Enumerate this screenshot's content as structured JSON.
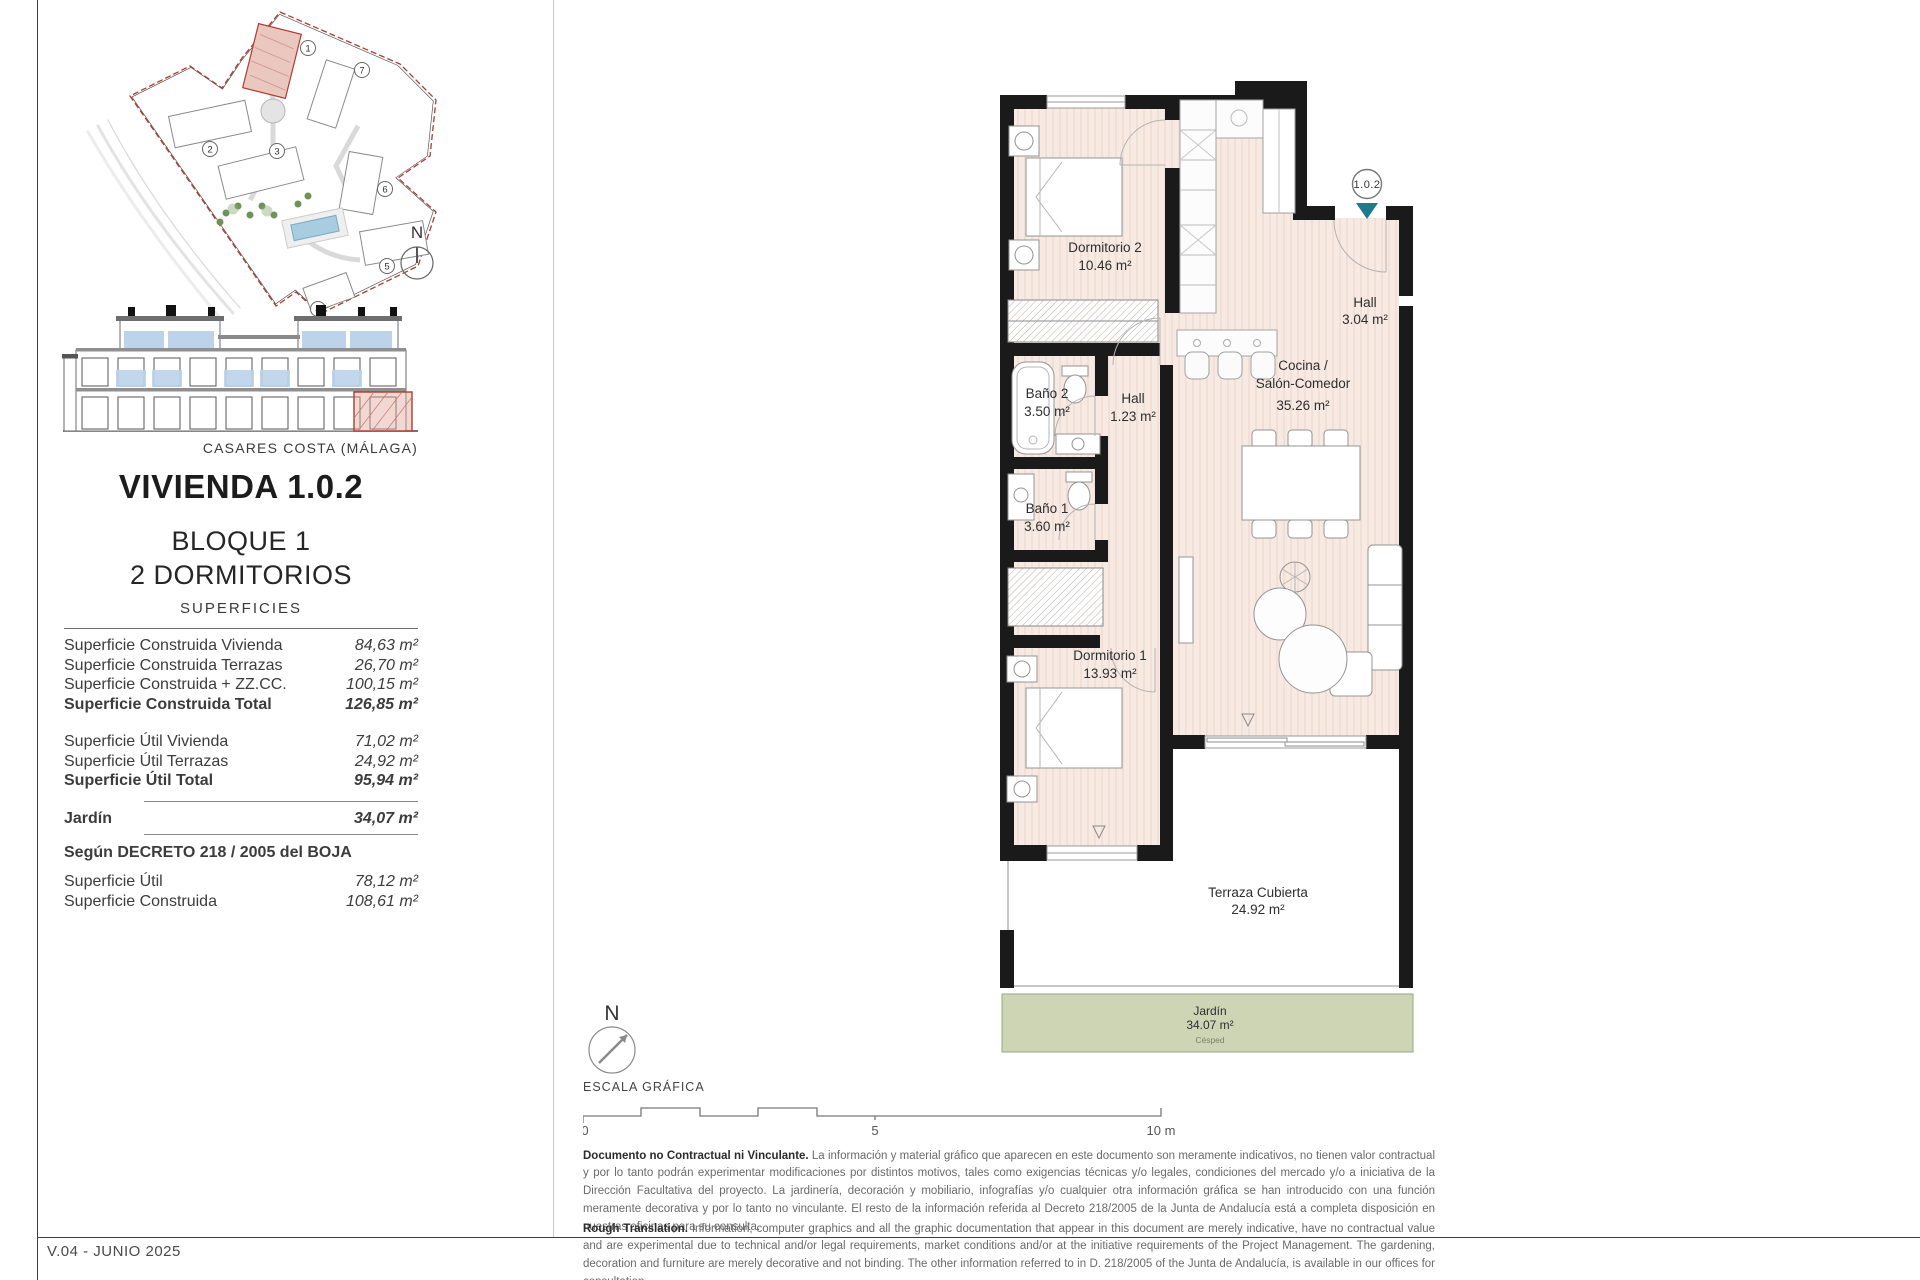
{
  "page": {
    "footer": "V.04 - JUNIO 2025",
    "caption": "CASARES COSTA (MÁLAGA)"
  },
  "header": {
    "title": "VIVIENDA 1.0.2",
    "block": "BLOQUE 1",
    "bedrooms": "2 DORMITORIOS"
  },
  "superficies": {
    "heading": "SUPERFICIES",
    "construida": [
      {
        "label": "Superficie Construida Vivienda",
        "value": "84,63 m²"
      },
      {
        "label": "Superficie Construida Terrazas",
        "value": "26,70 m²"
      },
      {
        "label": "Superficie Construida + ZZ.CC.",
        "value": "100,15 m²"
      },
      {
        "label": "Superficie Construida Total",
        "value": "126,85 m²"
      }
    ],
    "util": [
      {
        "label": "Superficie Útil Vivienda",
        "value": "71,02 m²"
      },
      {
        "label": "Superficie Útil Terrazas",
        "value": "24,92 m²"
      },
      {
        "label": "Superficie Útil Total",
        "value": "95,94 m²"
      }
    ],
    "jardin": {
      "label": "Jardín",
      "value": "34,07 m²"
    },
    "decreto_heading": "Según DECRETO 218 / 2005 del BOJA",
    "decreto": [
      {
        "label": "Superficie Útil",
        "value": "78,12 m²"
      },
      {
        "label": "Superficie Construida",
        "value": "108,61 m²"
      }
    ]
  },
  "floor_plan": {
    "unit_marker": "1.0.2",
    "rooms": [
      {
        "name": "Dormitorio 2",
        "area": "10.46 m²"
      },
      {
        "name": "Hall",
        "area": "3.04 m²"
      },
      {
        "name": "Baño 2",
        "area": "3.50 m²"
      },
      {
        "name": "Hall",
        "area": "1.23 m²"
      },
      {
        "name_line1": "Cocina /",
        "name_line2": "Salón-Comedor",
        "area": "35.26 m²"
      },
      {
        "name": "Baño 1",
        "area": "3.60 m²"
      },
      {
        "name": "Dormitorio 1",
        "area": "13.93 m²"
      },
      {
        "name": "Terraza Cubierta",
        "area": "24.92 m²"
      },
      {
        "name": "Jardín",
        "area": "34.07 m²",
        "note": "Césped"
      }
    ]
  },
  "site_plan": {
    "numbers": [
      "1",
      "2",
      "3",
      "4",
      "5",
      "6",
      "7"
    ]
  },
  "compass": {
    "label": "N"
  },
  "scale": {
    "label": "ESCALA GRÁFICA",
    "t0": "0",
    "t5": "5",
    "t10": "10 m"
  },
  "disclaimers": {
    "es_lead": "Documento no Contractual ni Vinculante.",
    "es_body": " La información y material gráfico que aparecen en este documento son meramente indicativos, no tienen valor contractual y por lo tanto podrán experimentar modificaciones por distintos motivos, tales como exigencias técnicas y/o legales, condiciones del mercado y/o a iniciativa de la Dirección Facultativa del proyecto. La jardinería, decoración y mobiliario, infografías y/o cualquier otra información gráfica se han introducido con una función meramente decorativa y por lo tanto no vinculante. El resto de la información referida al Decreto 218/2005 de la Junta de Andalucía está a completa disposición en nuestras oficinas para su consulta.",
    "en_lead": "Rough Translation.",
    "en_body": " Information, computer graphics and all the graphic documentation that appear in this document are merely indicative, have no contractual value and are experimental due to technical and/or legal requirements, market conditions and/or at the initiative requirements of the Project Management. The gardening, decoration and furniture are merely decorative and not binding. The other information referred to in D. 218/2005 of the Junta de Andalucía, is available in our offices for consultation."
  },
  "colors": {
    "floor_pink": "#f7eae3",
    "highlight_pink": "#eac7bf",
    "boundary_red": "#b23a2e",
    "garden_green": "#cdd5b5",
    "marker_teal": "#1e7a90",
    "balcony_blue": "#bcd3ea",
    "wall_black": "#1a1a1a"
  }
}
